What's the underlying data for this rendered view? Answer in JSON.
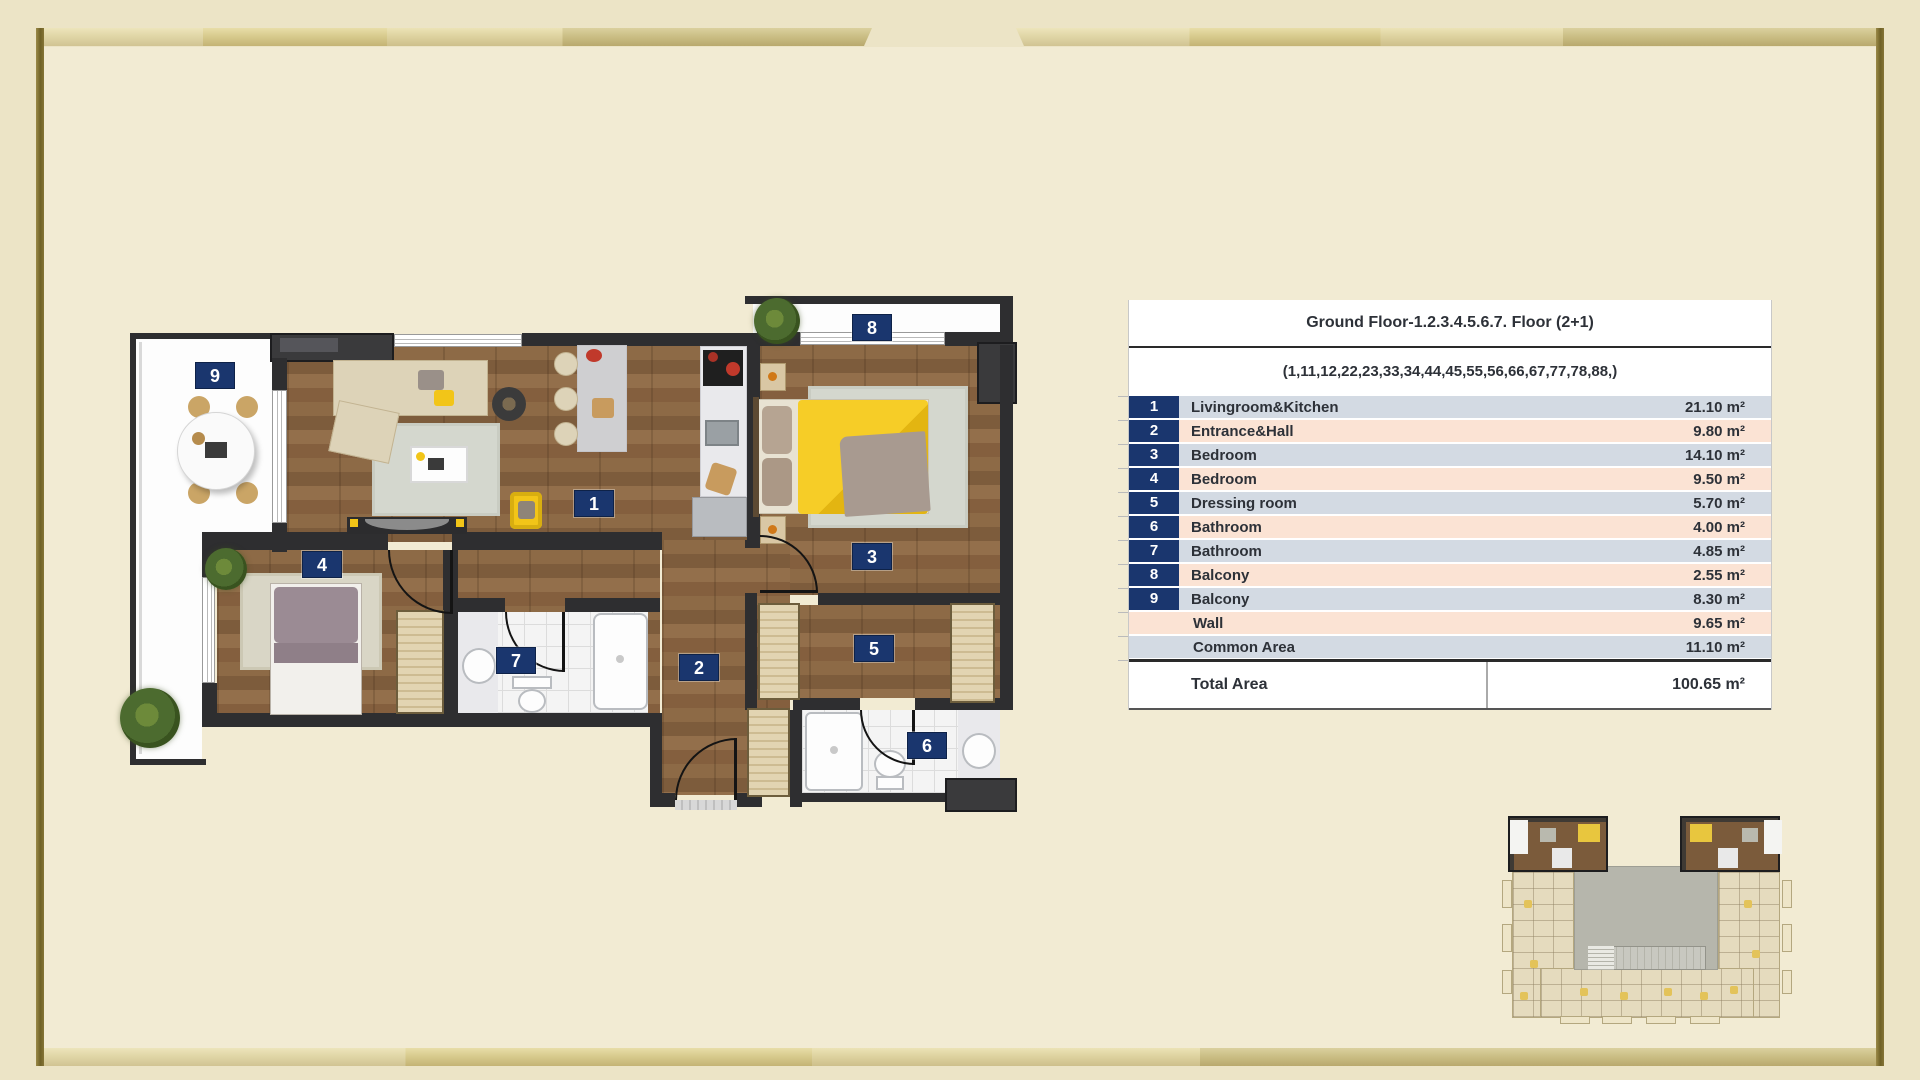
{
  "table": {
    "title": "Ground Floor-1.2.3.4.5.6.7. Floor (2+1)",
    "subtitle": "(1,11,12,22,23,33,34,44,45,55,56,66,67,77,78,88,)",
    "rows": [
      {
        "num": "1",
        "label": "Livingroom&Kitchen",
        "area": "21.10 m²"
      },
      {
        "num": "2",
        "label": "Entrance&Hall",
        "area": "9.80 m²"
      },
      {
        "num": "3",
        "label": "Bedroom",
        "area": "14.10 m²"
      },
      {
        "num": "4",
        "label": "Bedroom",
        "area": "9.50 m²"
      },
      {
        "num": "5",
        "label": "Dressing room",
        "area": "5.70 m²"
      },
      {
        "num": "6",
        "label": "Bathroom",
        "area": "4.00 m²"
      },
      {
        "num": "7",
        "label": "Bathroom",
        "area": "4.85 m²"
      },
      {
        "num": "8",
        "label": "Balcony",
        "area": "2.55 m²"
      },
      {
        "num": "9",
        "label": "Balcony",
        "area": "8.30 m²"
      },
      {
        "num": "",
        "label": "Wall",
        "area": "9.65 m²"
      },
      {
        "num": "",
        "label": "Common Area",
        "area": "11.10 m²"
      }
    ],
    "total_label": "Total Area",
    "total_value": "100.65 m²"
  },
  "floorplan": {
    "badges": [
      {
        "label": "1"
      },
      {
        "label": "2"
      },
      {
        "label": "3"
      },
      {
        "label": "4"
      },
      {
        "label": "5"
      },
      {
        "label": "6"
      },
      {
        "label": "7"
      },
      {
        "label": "8"
      },
      {
        "label": "9"
      }
    ]
  },
  "colors": {
    "accent_navy": "#1a366e",
    "row_blue": "#d3dae3",
    "row_peach": "#fbe3d4",
    "frame_gold": "#d8cb8e",
    "background": "#ece4c6"
  }
}
